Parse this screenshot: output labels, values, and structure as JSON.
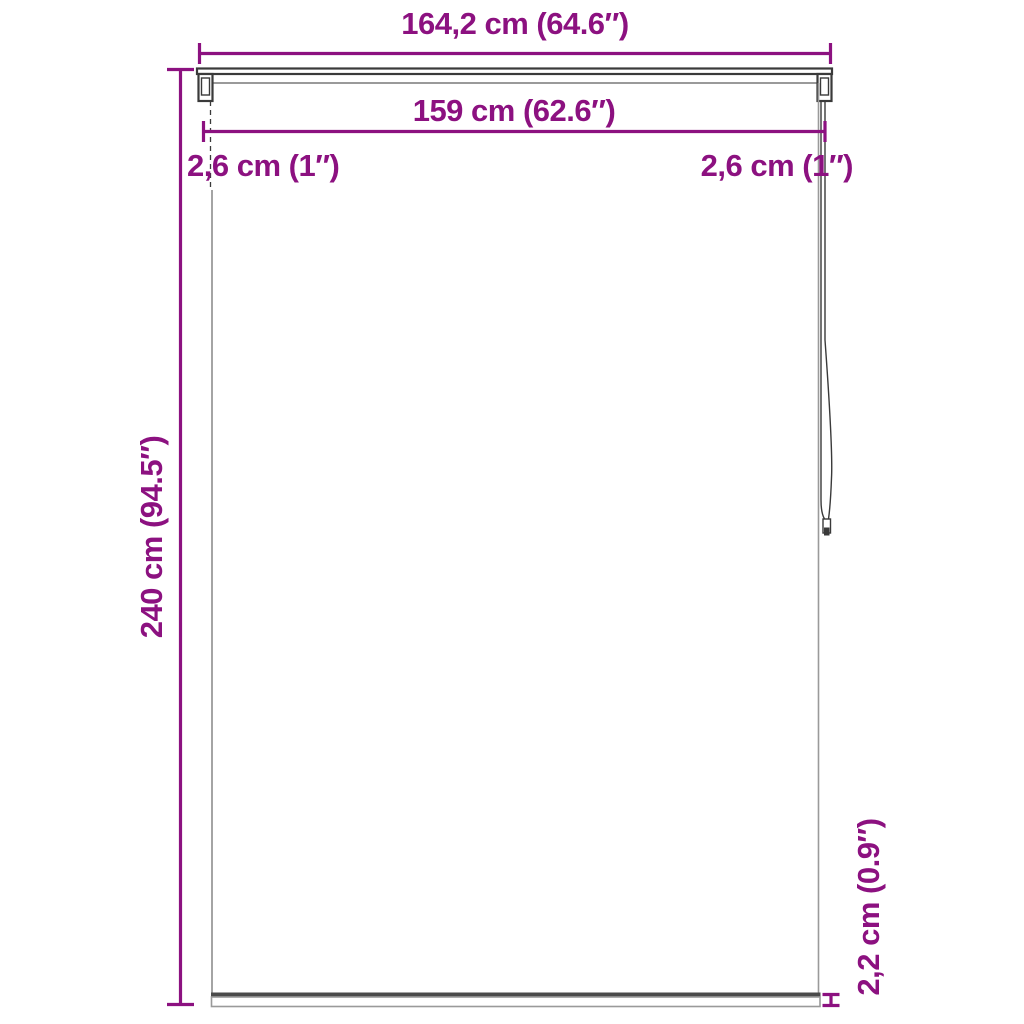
{
  "dimensions": {
    "total_width": "164,2 cm (64.6″)",
    "fabric_width": "159 cm (62.6″)",
    "left_offset": "2,6 cm (1″)",
    "right_offset": "2,6 cm (1″)",
    "height": "240 cm (94.5″)",
    "bottom_bar_height": "2,2 cm (0.9″)"
  },
  "colors": {
    "accent": "#8C1180",
    "line_dark": "#3a3a3a",
    "line_light": "#9a9a9a",
    "background": "#ffffff"
  }
}
